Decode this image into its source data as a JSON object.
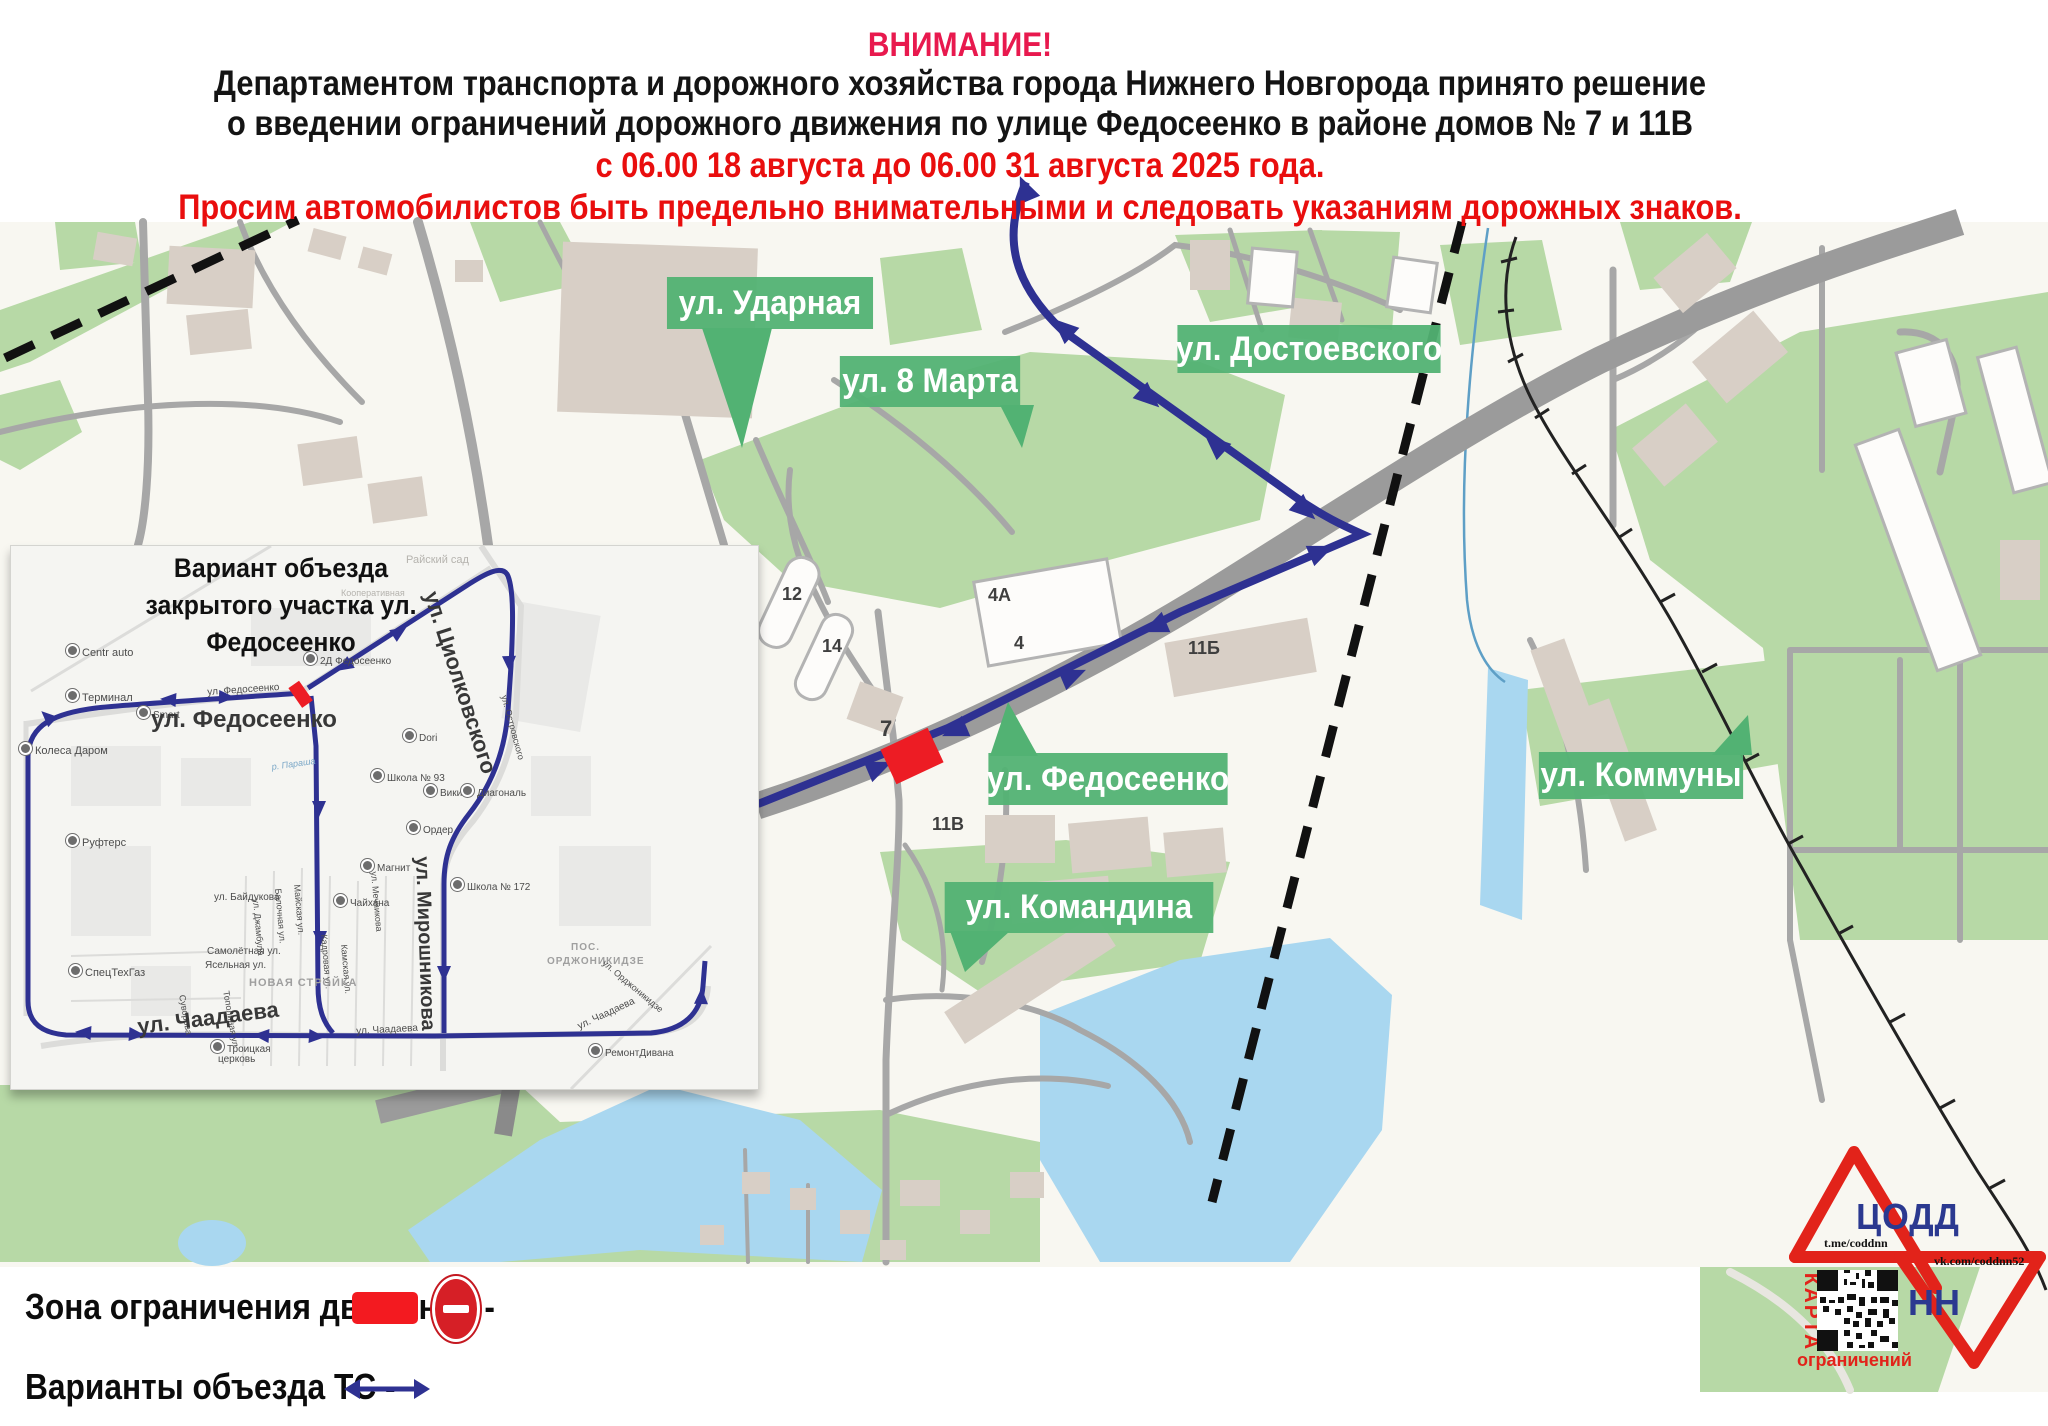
{
  "header": {
    "attention": "ВНИМАНИЕ!",
    "line1": "Департаментом транспорта и дорожного хозяйства города Нижнего Новгорода принято решение",
    "line2": "о введении ограничений дорожного движения по улице Федосеенко в районе домов  № 7 и 11В",
    "dates": "с 06.00 18 августа до 06.00 31 августа 2025 года.",
    "warning": "Просим автомобилистов быть предельно внимательными и следовать указаниям дорожных знаков."
  },
  "colors": {
    "attention_pink": "#e8194e",
    "warning_red": "#e90e0e",
    "route_navy": "#2e3192",
    "restriction_red": "#ed1c24",
    "street_label_green": "#52b273",
    "map_green": "#b7d9a6",
    "water_blue": "#a9d7f0",
    "road_gray": "#a7a7a7",
    "building_beige": "#d8cfc6",
    "logo_red": "#e2231a",
    "logo_navy": "#2b3990"
  },
  "map": {
    "street_labels": [
      {
        "t": "ул. Ударная",
        "x": 658,
        "y": 277,
        "w": 224,
        "h": 52
      },
      {
        "t": "ул. 8 Марта",
        "x": 832,
        "y": 356,
        "w": 196,
        "h": 51
      },
      {
        "t": "ул. Достоевского",
        "x": 1166,
        "y": 325,
        "w": 286,
        "h": 48
      },
      {
        "t": "ул. Федосеенко",
        "x": 978,
        "y": 753,
        "w": 260,
        "h": 52
      },
      {
        "t": "ул. Командина",
        "x": 933,
        "y": 882,
        "w": 292,
        "h": 51
      },
      {
        "t": "ул. Коммуны",
        "x": 1530,
        "y": 752,
        "w": 222,
        "h": 47
      }
    ],
    "house_numbers": [
      {
        "t": "12",
        "x": 782,
        "y": 584,
        "s": 18
      },
      {
        "t": "14",
        "x": 822,
        "y": 636,
        "s": 18
      },
      {
        "t": "4А",
        "x": 988,
        "y": 585,
        "s": 18
      },
      {
        "t": "4",
        "x": 1014,
        "y": 633,
        "s": 18
      },
      {
        "t": "11Б",
        "x": 1188,
        "y": 638,
        "s": 18
      },
      {
        "t": "7",
        "x": 880,
        "y": 716,
        "s": 22
      },
      {
        "t": "11В",
        "x": 932,
        "y": 814,
        "s": 18
      }
    ]
  },
  "inset": {
    "title1": "Вариант объезда",
    "title2": "закрытого участка ул. Федосеенко",
    "labels": [
      {
        "t": "Райский сад",
        "x": 395,
        "y": 8,
        "s": 11,
        "c": "faint"
      },
      {
        "t": "Кооперативная",
        "x": 330,
        "y": 42,
        "s": 9,
        "c": "faint"
      },
      {
        "t": "Centr auto",
        "x": 55,
        "y": 98,
        "s": 11,
        "c": "poi"
      },
      {
        "t": "Терминал",
        "x": 55,
        "y": 143,
        "s": 11,
        "c": "poi"
      },
      {
        "t": "Smart",
        "x": 126,
        "y": 160,
        "s": 10,
        "c": "poi"
      },
      {
        "t": "ул. Федосеенко",
        "x": 196,
        "y": 141,
        "s": 10,
        "r": -4
      },
      {
        "t": "ул. Федосеенко",
        "x": 140,
        "y": 160,
        "s": 24,
        "c": "big"
      },
      {
        "t": "2Д Федосеенко",
        "x": 293,
        "y": 106,
        "s": 10,
        "c": "poi"
      },
      {
        "t": "Колеса Даром",
        "x": 8,
        "y": 196,
        "s": 11,
        "c": "poi"
      },
      {
        "t": "Руфтерс",
        "x": 55,
        "y": 288,
        "s": 11,
        "c": "poi"
      },
      {
        "t": "СпецТехГаз",
        "x": 58,
        "y": 418,
        "s": 11,
        "c": "poi"
      },
      {
        "t": "ул. Циолковского",
        "x": 432,
        "y": 42,
        "s": 22,
        "r": 72,
        "c": "big"
      },
      {
        "t": "ул. Островского",
        "x": 498,
        "y": 148,
        "s": 9,
        "r": 75
      },
      {
        "t": "ул. Мечникова",
        "x": 368,
        "y": 325,
        "s": 9,
        "r": 85
      },
      {
        "t": "Dori",
        "x": 392,
        "y": 183,
        "s": 10,
        "c": "poi"
      },
      {
        "t": "Школа № 93",
        "x": 360,
        "y": 223,
        "s": 10,
        "c": "poi"
      },
      {
        "t": "Викинг",
        "x": 413,
        "y": 238,
        "s": 10,
        "c": "poi"
      },
      {
        "t": "Диагональ",
        "x": 450,
        "y": 238,
        "s": 10,
        "c": "poi"
      },
      {
        "t": "Ордер",
        "x": 396,
        "y": 275,
        "s": 10,
        "c": "poi"
      },
      {
        "t": "Магнит",
        "x": 350,
        "y": 313,
        "s": 10,
        "c": "poi"
      },
      {
        "t": "Чайхана",
        "x": 323,
        "y": 348,
        "s": 10,
        "c": "poi"
      },
      {
        "t": "Школа № 172",
        "x": 440,
        "y": 332,
        "s": 10,
        "c": "poi"
      },
      {
        "t": "ул. Мирошникова",
        "x": 422,
        "y": 310,
        "s": 20,
        "r": 88,
        "c": "big"
      },
      {
        "t": "р. Параша",
        "x": 260,
        "y": 216,
        "s": 9,
        "r": -8,
        "c": "water"
      },
      {
        "t": "ул. Байдукова",
        "x": 203,
        "y": 346,
        "s": 10
      },
      {
        "t": "ул. Джамбула",
        "x": 250,
        "y": 352,
        "s": 9,
        "r": 85
      },
      {
        "t": "Балочная ул.",
        "x": 272,
        "y": 342,
        "s": 9,
        "r": 85
      },
      {
        "t": "Майская ул.",
        "x": 291,
        "y": 338,
        "s": 9,
        "r": 85
      },
      {
        "t": "Кадровая ул.",
        "x": 318,
        "y": 388,
        "s": 9,
        "r": 85
      },
      {
        "t": "Камская ул.",
        "x": 338,
        "y": 398,
        "s": 9,
        "r": 85
      },
      {
        "t": "Самолётная ул.",
        "x": 196,
        "y": 400,
        "s": 10
      },
      {
        "t": "Ясельная ул.",
        "x": 194,
        "y": 414,
        "s": 10
      },
      {
        "t": "НОВАЯ СТРОЙКА",
        "x": 238,
        "y": 431,
        "s": 11,
        "c": "area"
      },
      {
        "t": "ПОС.",
        "x": 560,
        "y": 396,
        "s": 10,
        "c": "area"
      },
      {
        "t": "ОРДЖОНИКИДЗЕ",
        "x": 536,
        "y": 410,
        "s": 10,
        "c": "area"
      },
      {
        "t": "ул. Орджоникидзе",
        "x": 596,
        "y": 412,
        "s": 9,
        "r": 40
      },
      {
        "t": "Суворова",
        "x": 176,
        "y": 448,
        "s": 9,
        "r": 80
      },
      {
        "t": "Тополиная ул.",
        "x": 220,
        "y": 444,
        "s": 9,
        "r": 80
      },
      {
        "t": "ул. Чаадаева",
        "x": 125,
        "y": 468,
        "s": 22,
        "r": -7,
        "c": "big"
      },
      {
        "t": "ул. Чаадаева",
        "x": 345,
        "y": 480,
        "s": 10,
        "r": -3
      },
      {
        "t": "ул. Чаадаева",
        "x": 565,
        "y": 476,
        "s": 10,
        "r": -25
      },
      {
        "t": "Троицкая",
        "x": 200,
        "y": 494,
        "s": 10,
        "c": "poi"
      },
      {
        "t": "церковь",
        "x": 207,
        "y": 508,
        "s": 10
      },
      {
        "t": "РемонтДивана",
        "x": 578,
        "y": 498,
        "s": 10,
        "c": "poi"
      }
    ]
  },
  "legend": {
    "restriction_label": "Зона ограничения движения -",
    "detour_label": "Варианты объезда ТС -"
  },
  "logo": {
    "org": "ЦОДД",
    "org2": "НН",
    "telegram": "t.me/coddnn",
    "vk": "vk.com/coddnn52",
    "qr_caption_vertical": "КАРТА",
    "qr_caption_bottom": "ограничений"
  }
}
